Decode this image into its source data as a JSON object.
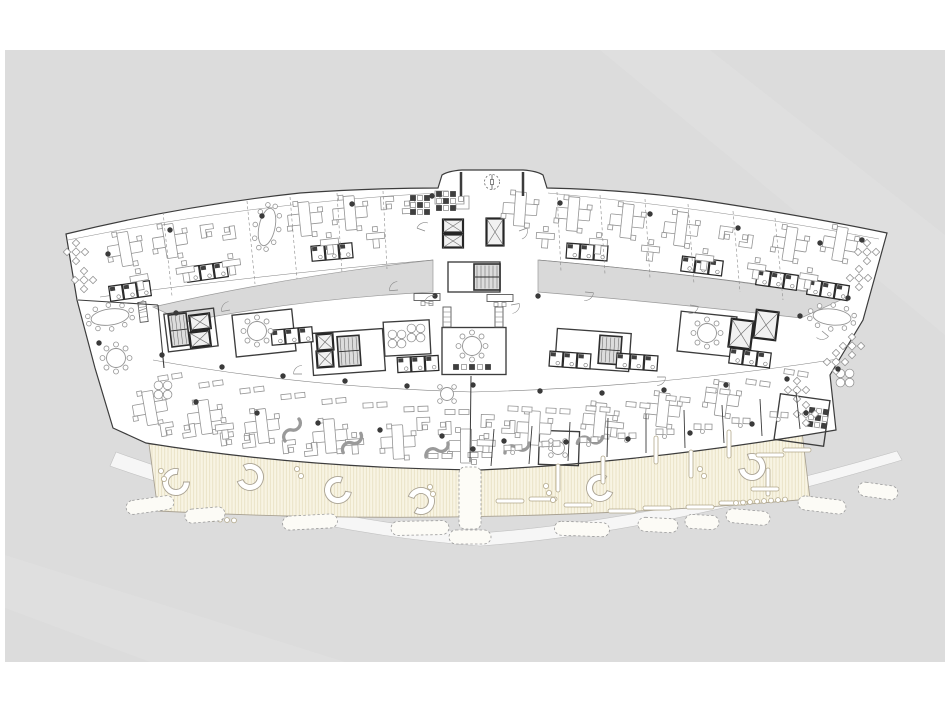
{
  "meta": {
    "drawing_type": "architectural floor plan",
    "subject": "curved wing office building, typical office level with open terrace",
    "visible_text": "none"
  },
  "canvas": {
    "width": 950,
    "height": 713,
    "page_bg": "#ffffff",
    "drawing_bg": "#dcdcdc",
    "margin": {
      "x": 5,
      "y": 50,
      "w": 940,
      "h": 612
    }
  },
  "palette": {
    "wall": "#3c3c3c",
    "wall_dark": "#262626",
    "furniture": "#949494",
    "furniture_dark": "#3f3f3f",
    "white": "#ffffff",
    "core_fill": "#f1f1f1",
    "stair_fill": "#dcdcdc",
    "courtyard": "#d9d9d9",
    "terrace_fill": "#f8f4e3",
    "terrace_stripe": "#e4dbbc",
    "terrace_edge": "#a9a293",
    "hedge": "#9a9a9a",
    "walkway_fill": "#f6f6f6",
    "walkway_edge": "#c2c2c2",
    "column": "#3a3a3a",
    "line_light": "#8a8a8a"
  },
  "outlines": [
    {
      "name": "scan-streak-1",
      "d": "M600,50 L945,335 L945,235 L710,50 Z",
      "fill": "#e2e2e2",
      "stroke": "none",
      "sw": 0,
      "opacity": 0.55
    },
    {
      "name": "scan-streak-2",
      "d": "M5,555 L345,662 L150,662 L5,608 Z",
      "fill": "#e2e2e2",
      "stroke": "none",
      "sw": 0,
      "opacity": 0.45
    },
    {
      "name": "walkway-band",
      "d": "M110,466 Q300,533 480,546 Q662,533 902,460 L897,451 Q662,520 480,533 Q300,519 116,452 Z",
      "fill": "#f6f6f6",
      "stroke": "#c2c2c2",
      "sw": 0.6,
      "opacity": 1
    },
    {
      "name": "terrace-deck",
      "d": "M149,444 Q480,477 802,432 L810,499 Q480,528 158,511 Z",
      "fill": "url(#tpat)",
      "stroke": "#a9a293",
      "sw": 0.9,
      "opacity": 1
    },
    {
      "name": "building-silhouette",
      "d": "M66,234 Q180,206 300,193 Q370,188 438,188 L442,175 Q448,171 462,170 L523,170 Q537,171 543,175 L547,188 Q640,190 720,203 Q810,217 887,233 L863,320 L830,375 L836,430 Q650,462 480,470 Q300,468 146,443 L113,428 L95,368 L77,300 Z",
      "fill": "#ffffff",
      "stroke": "#3c3c3c",
      "sw": 1.2,
      "opacity": 1
    },
    {
      "name": "courtyard-left",
      "d": "M153,307 Q290,276 433,260 L433,292 Q300,299 185,322 Z",
      "fill": "#d9d9d9",
      "stroke": "#9a9a9a",
      "sw": 0.7,
      "opacity": 1
    },
    {
      "name": "courtyard-right",
      "d": "M538,260 Q700,274 845,298 L801,318 Q660,302 538,292 Z",
      "fill": "#d9d9d9",
      "stroke": "#9a9a9a",
      "sw": 0.7,
      "opacity": 1
    },
    {
      "name": "corridor-line-north-left",
      "d": "M100,297 Q250,276 433,260",
      "fill": "none",
      "stroke": "#808080",
      "sw": 0.55,
      "opacity": 1
    },
    {
      "name": "corridor-line-north-right",
      "d": "M539,260 Q700,274 846,297",
      "fill": "none",
      "stroke": "#808080",
      "sw": 0.55,
      "opacity": 1
    },
    {
      "name": "corridor-line-south",
      "d": "M153,360 Q300,387 472,392 Q650,388 838,359",
      "fill": "none",
      "stroke": "#808080",
      "sw": 0.55,
      "opacity": 1
    },
    {
      "name": "wing-inner-line-left",
      "d": "M68,240 Q250,203 437,193",
      "fill": "none",
      "stroke": "#8d8d8d",
      "sw": 0.5,
      "opacity": 1
    },
    {
      "name": "wing-inner-line-right",
      "d": "M548,193 Q720,209 879,239",
      "fill": "none",
      "stroke": "#8d8d8d",
      "sw": 0.5,
      "opacity": 1
    }
  ],
  "items": {
    "rooms": [
      [
        264,
        333,
        60,
        42,
        -6
      ],
      [
        474,
        351,
        64,
        47,
        0
      ],
      [
        707,
        334,
        56,
        40,
        6
      ],
      [
        407,
        338,
        46,
        34,
        -3
      ],
      [
        348,
        352,
        72,
        42,
        -4
      ],
      [
        593,
        350,
        74,
        38,
        4
      ],
      [
        191,
        330,
        50,
        38,
        -7
      ],
      [
        474,
        277,
        52,
        30,
        0
      ],
      [
        559,
        448,
        40,
        34,
        2
      ],
      [
        802,
        420,
        50,
        46,
        8
      ]
    ],
    "strips": [
      [
        470,
        498,
        22,
        62,
        0
      ]
    ],
    "stairs": [
      [
        487,
        277,
        26,
        26,
        0
      ],
      [
        349,
        351,
        22,
        30,
        -4
      ],
      [
        179,
        330,
        18,
        32,
        -7
      ],
      [
        610,
        350,
        22,
        28,
        4
      ]
    ],
    "elevators": [
      [
        453,
        226,
        20,
        13,
        0
      ],
      [
        453,
        241,
        20,
        13,
        0
      ],
      [
        495,
        232,
        17,
        27,
        0
      ],
      [
        200,
        322,
        20,
        15,
        -7
      ],
      [
        200,
        339,
        20,
        15,
        -7
      ],
      [
        325,
        342,
        16,
        16,
        -4
      ],
      [
        325,
        359,
        16,
        16,
        -4
      ],
      [
        741,
        334,
        22,
        28,
        7
      ],
      [
        766,
        325,
        22,
        28,
        7
      ]
    ],
    "wc": [
      [
        207,
        272,
        -8
      ],
      [
        332,
        252,
        -5
      ],
      [
        587,
        252,
        4
      ],
      [
        702,
        266,
        7
      ],
      [
        777,
        280,
        8
      ],
      [
        130,
        291,
        -8
      ],
      [
        828,
        290,
        9
      ],
      [
        292,
        336,
        -5
      ],
      [
        418,
        364,
        -3
      ],
      [
        750,
        358,
        7
      ],
      [
        570,
        360,
        4
      ],
      [
        637,
        362,
        4
      ]
    ],
    "desks_plus": [
      [
        125,
        249,
        -10
      ],
      [
        170,
        241,
        -9
      ],
      [
        305,
        219,
        -6
      ],
      [
        350,
        213,
        -5
      ],
      [
        520,
        209,
        4
      ],
      [
        573,
        214,
        5
      ],
      [
        627,
        221,
        6
      ],
      [
        681,
        229,
        7
      ],
      [
        790,
        244,
        9
      ],
      [
        840,
        244,
        10
      ],
      [
        150,
        408,
        -10
      ],
      [
        205,
        417,
        -8
      ],
      [
        262,
        426,
        -7
      ],
      [
        330,
        436,
        -5
      ],
      [
        398,
        442,
        -3
      ],
      [
        466,
        446,
        0
      ],
      [
        534,
        428,
        3
      ],
      [
        600,
        420,
        5
      ],
      [
        663,
        410,
        6
      ],
      [
        722,
        399,
        8
      ]
    ],
    "desks_L2": [
      [
        218,
        232,
        -8
      ],
      [
        398,
        205,
        -3
      ],
      [
        452,
        200,
        0
      ],
      [
        736,
        237,
        8
      ],
      [
        178,
        430,
        -9
      ],
      [
        238,
        440,
        -7
      ],
      [
        300,
        448,
        -6
      ],
      [
        434,
        426,
        -2
      ],
      [
        498,
        424,
        2
      ]
    ],
    "desks_T": [
      [
        140,
        283,
        -10
      ],
      [
        186,
        275,
        -9
      ],
      [
        232,
        268,
        -8
      ],
      [
        330,
        247,
        -6
      ],
      [
        376,
        241,
        -5
      ],
      [
        545,
        241,
        4
      ],
      [
        598,
        247,
        5
      ],
      [
        650,
        254,
        6
      ],
      [
        704,
        263,
        7
      ],
      [
        756,
        272,
        8
      ],
      [
        808,
        282,
        9
      ],
      [
        225,
        432,
        -7
      ],
      [
        355,
        447,
        -4
      ],
      [
        486,
        448,
        2
      ],
      [
        614,
        430,
        6
      ]
    ],
    "pairs": [
      [
        170,
        377,
        -9
      ],
      [
        211,
        384,
        -8
      ],
      [
        252,
        390,
        -7
      ],
      [
        293,
        396,
        -6
      ],
      [
        334,
        401,
        -5
      ],
      [
        375,
        405,
        -3
      ],
      [
        416,
        409,
        -2
      ],
      [
        457,
        412,
        0
      ],
      [
        520,
        409,
        3
      ],
      [
        558,
        411,
        3
      ],
      [
        598,
        409,
        4
      ],
      [
        638,
        405,
        5
      ],
      [
        678,
        399,
        6
      ],
      [
        718,
        391,
        7
      ],
      [
        758,
        383,
        8
      ],
      [
        796,
        373,
        9
      ],
      [
        440,
        456,
        0
      ],
      [
        480,
        455,
        0
      ]
    ],
    "stools": [
      [
        420,
        205,
        0
      ],
      [
        446,
        201,
        0
      ],
      [
        818,
        418,
        8
      ]
    ],
    "srow": [
      [
        472,
        367,
        0
      ]
    ],
    "flower": [
      [
        163,
        390,
        0
      ],
      [
        397,
        339,
        0
      ],
      [
        416,
        333,
        0
      ],
      [
        845,
        378,
        0
      ]
    ],
    "dia4": [
      [
        76,
        252,
        0
      ],
      [
        84,
        280,
        0
      ],
      [
        867,
        252,
        0
      ],
      [
        859,
        278,
        0
      ],
      [
        852,
        346,
        0
      ],
      [
        836,
        362,
        0
      ],
      [
        797,
        390,
        0
      ],
      [
        806,
        414,
        0
      ]
    ],
    "round8": [
      [
        257,
        331,
        0
      ],
      [
        472,
        346,
        0
      ],
      [
        707,
        333,
        0
      ],
      [
        116,
        358,
        0
      ]
    ],
    "round4": [
      [
        447,
        394,
        0
      ],
      [
        558,
        448,
        0
      ]
    ],
    "oval": [
      [
        110,
        317,
        -8
      ],
      [
        832,
        317,
        6
      ],
      [
        267,
        227,
        -78
      ]
    ],
    "recep": [
      [
        427,
        297,
        0
      ],
      [
        500,
        298,
        0
      ]
    ],
    "shelf": [
      [
        447,
        317,
        0
      ],
      [
        499,
        317,
        0
      ],
      [
        143,
        312,
        -7
      ]
    ],
    "screens": [
      [
        292,
        430,
        -25
      ],
      [
        352,
        443,
        -15
      ],
      [
        437,
        450,
        0
      ],
      [
        517,
        448,
        10
      ],
      [
        590,
        440,
        18
      ]
    ],
    "dod": [
      [
        513,
        448,
        -2
      ],
      [
        551,
        444,
        -2
      ],
      [
        589,
        440,
        -1
      ],
      [
        627,
        436,
        -1
      ],
      [
        665,
        432,
        0
      ],
      [
        703,
        427,
        1
      ],
      [
        741,
        421,
        2
      ],
      [
        779,
        415,
        3
      ]
    ],
    "benches": [
      [
        176,
        482,
        -40
      ],
      [
        250,
        477,
        200
      ],
      [
        338,
        490,
        -30
      ],
      [
        421,
        501,
        160
      ],
      [
        600,
        488,
        -20
      ],
      [
        752,
        467,
        210
      ]
    ],
    "pv": [
      [
        558,
        478
      ],
      [
        603,
        470
      ],
      [
        656,
        450
      ],
      [
        691,
        464
      ],
      [
        729,
        444
      ],
      [
        768,
        482
      ]
    ],
    "ph": [
      [
        510,
        501
      ],
      [
        543,
        499
      ],
      [
        578,
        505
      ],
      [
        622,
        511
      ],
      [
        657,
        508
      ],
      [
        700,
        507
      ],
      [
        733,
        503
      ],
      [
        765,
        489
      ],
      [
        770,
        455
      ],
      [
        797,
        450
      ]
    ],
    "pots": [
      [
        161,
        471
      ],
      [
        164,
        479
      ],
      [
        297,
        469
      ],
      [
        301,
        476
      ],
      [
        546,
        486
      ],
      [
        549,
        493
      ],
      [
        553,
        500
      ],
      [
        430,
        487
      ],
      [
        433,
        494
      ],
      [
        700,
        469
      ],
      [
        704,
        476
      ]
    ],
    "potrows": [
      [
        192,
        518,
        7,
        7,
        0.4
      ],
      [
        736,
        503,
        8,
        7,
        -0.5
      ],
      [
        403,
        528,
        7,
        6,
        0.3
      ]
    ],
    "hedges": [
      [
        150,
        505,
        48,
        -8
      ],
      [
        205,
        515,
        40,
        -5
      ],
      [
        310,
        522,
        55,
        -3
      ],
      [
        420,
        528,
        58,
        -1
      ],
      [
        470,
        537,
        42,
        0
      ],
      [
        582,
        529,
        55,
        2
      ],
      [
        658,
        525,
        40,
        3
      ],
      [
        702,
        522,
        34,
        3
      ],
      [
        748,
        517,
        44,
        5
      ],
      [
        822,
        505,
        48,
        7
      ],
      [
        878,
        491,
        40,
        8
      ]
    ],
    "bars": [
      [
        78,
        300,
        158,
        305,
        1.1
      ],
      [
        158,
        305,
        164,
        368,
        1.1
      ],
      [
        461,
        172,
        461,
        196,
        2.5
      ],
      [
        523,
        172,
        523,
        196,
        2.5
      ],
      [
        471,
        376,
        470,
        462,
        1
      ],
      [
        494,
        429,
        491,
        466,
        0.9
      ],
      [
        532,
        426,
        529,
        464,
        0.9
      ],
      [
        570,
        422,
        568,
        461,
        0.9
      ],
      [
        608,
        418,
        607,
        457,
        0.9
      ],
      [
        646,
        414,
        646,
        453,
        0.9
      ],
      [
        684,
        410,
        685,
        448,
        0.9
      ],
      [
        722,
        405,
        724,
        443,
        0.9
      ],
      [
        760,
        399,
        762,
        436,
        0.9
      ],
      [
        796,
        392,
        800,
        429,
        0.9
      ]
    ],
    "dashes": [
      [
        163,
        212,
        172,
        296
      ],
      [
        247,
        201,
        255,
        284
      ],
      [
        290,
        197,
        297,
        279
      ],
      [
        337,
        193,
        342,
        273
      ],
      [
        383,
        191,
        387,
        269
      ],
      [
        557,
        192,
        561,
        271
      ],
      [
        600,
        195,
        605,
        274
      ],
      [
        645,
        199,
        650,
        278
      ],
      [
        688,
        204,
        694,
        284
      ],
      [
        733,
        211,
        740,
        292
      ],
      [
        775,
        218,
        783,
        300
      ]
    ],
    "columns": [
      [
        162,
        355
      ],
      [
        222,
        367
      ],
      [
        283,
        376
      ],
      [
        345,
        381
      ],
      [
        407,
        386
      ],
      [
        540,
        391
      ],
      [
        602,
        393
      ],
      [
        664,
        390
      ],
      [
        726,
        385
      ],
      [
        787,
        379
      ],
      [
        838,
        369
      ],
      [
        196,
        402
      ],
      [
        257,
        413
      ],
      [
        318,
        423
      ],
      [
        380,
        430
      ],
      [
        442,
        436
      ],
      [
        504,
        441
      ],
      [
        566,
        442
      ],
      [
        628,
        439
      ],
      [
        690,
        433
      ],
      [
        752,
        424
      ],
      [
        806,
        413
      ],
      [
        108,
        254
      ],
      [
        170,
        230
      ],
      [
        262,
        216
      ],
      [
        352,
        204
      ],
      [
        432,
        196
      ],
      [
        560,
        203
      ],
      [
        650,
        214
      ],
      [
        738,
        228
      ],
      [
        820,
        243
      ],
      [
        862,
        240
      ],
      [
        176,
        313
      ],
      [
        435,
        296
      ],
      [
        538,
        296
      ],
      [
        800,
        316
      ],
      [
        848,
        298
      ],
      [
        473,
        385
      ],
      [
        473,
        449
      ],
      [
        99,
        343
      ]
    ],
    "doors": [
      [
        147,
        308,
        160
      ],
      [
        230,
        310,
        170
      ],
      [
        398,
        290,
        175
      ],
      [
        585,
        292,
        5
      ],
      [
        690,
        305,
        10
      ],
      [
        433,
        304,
        190
      ],
      [
        511,
        305,
        -10
      ],
      [
        302,
        374,
        180
      ],
      [
        657,
        377,
        0
      ],
      [
        822,
        331,
        40
      ],
      [
        425,
        231,
        200
      ],
      [
        519,
        231,
        -20
      ]
    ],
    "rev": [
      [
        492,
        182
      ]
    ]
  }
}
